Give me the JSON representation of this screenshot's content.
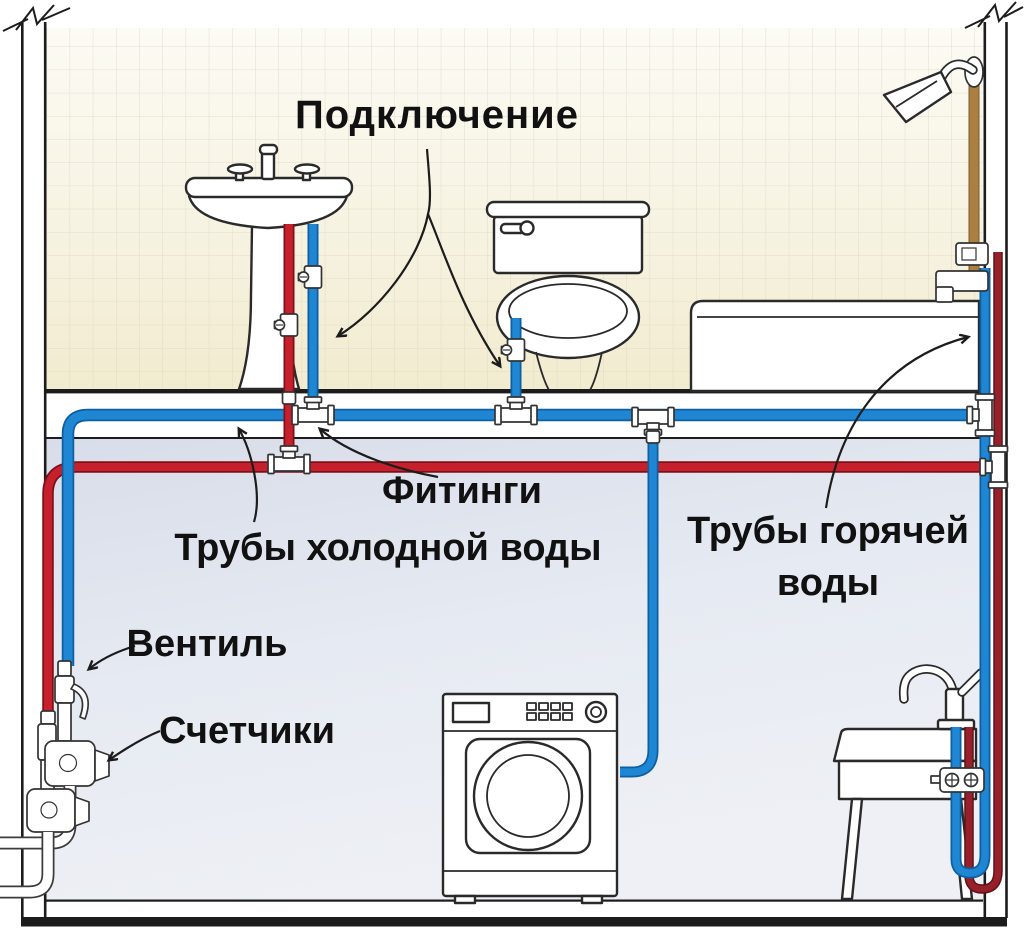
{
  "labels": {
    "connection": "Подключение",
    "fittings": "Фитинги",
    "cold_pipes": "Трубы холодной воды",
    "hot_pipes_line1": "Трубы горячей",
    "hot_pipes_line2": "воды",
    "valve": "Вентиль",
    "meters": "Счетчики"
  },
  "colors": {
    "cold_pipe": "#1e86d2",
    "cold_pipe_dark": "#0d5fa0",
    "hot_pipe": "#c5202c",
    "hot_pipe_dark": "#7e1018",
    "hot_riser": "#97202a",
    "hot_riser_dark": "#5f1216",
    "shower_pipe": "#ab7e42",
    "shower_pipe_dark": "#7c5a2b",
    "tile_wall_top": "#fcfbf4",
    "tile_wall_bottom": "#f1ebcf",
    "tile_grid_line": "#d9d5bf",
    "basement_top": "#d8dde9",
    "basement_bottom": "#eef0f5",
    "outline": "#1c1c1c",
    "fixture_outline": "#2a2a2a",
    "label_text": "#111111"
  },
  "fixtures": [
    "pedestal-sink",
    "toilet",
    "bathtub",
    "shower",
    "washing-machine",
    "laundry-sink",
    "ball-valve",
    "water-meter",
    "tee-fitting",
    "shutoff-valve"
  ]
}
